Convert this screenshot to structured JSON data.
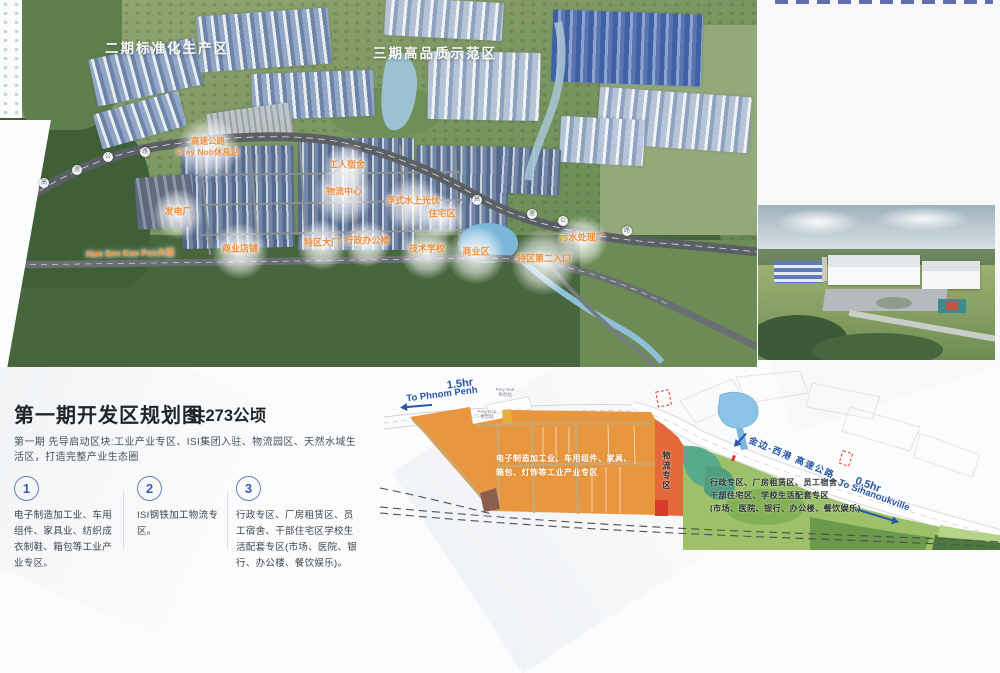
{
  "masterplan": {
    "zones": [
      {
        "label": "二期标准化生产区"
      },
      {
        "label": "三期高品质示范区"
      }
    ],
    "pois": [
      {
        "label": "高速公路"
      },
      {
        "label": "Prey Nob休息站"
      },
      {
        "label": "工人宿舍"
      },
      {
        "label": "物流中心"
      },
      {
        "label": "发电厂"
      },
      {
        "label": "浮式水上光伏"
      },
      {
        "label": "住宅区"
      },
      {
        "label": "商业店铺"
      },
      {
        "label": "特区大门"
      },
      {
        "label": "行政办公楼"
      },
      {
        "label": "技术学校"
      },
      {
        "label": "商业区"
      },
      {
        "label": "特区第二入口"
      },
      {
        "label": "污水处理厂"
      }
    ],
    "avenue_label": "Hun Sen Kao Pos大道",
    "road_shield_chars": [
      "高",
      "速",
      "公",
      "路",
      "高",
      "速",
      "公",
      "路"
    ],
    "label_color": "#ef8f3c"
  },
  "intro": {
    "title": "第一期开发区规划图",
    "area": "共273公顷",
    "subtitle": "第一期 先导启动区块:工业产业专区、ISI集团入驻、物流园区、天然水域生活区，打造完整产业生态圈",
    "items": [
      {
        "num": "1",
        "text": "电子制造加工业、车用组件、家具业、纺织成衣制鞋、箱包等工业产业专区。"
      },
      {
        "num": "2",
        "text": "ISI钢铁加工物流专区。"
      },
      {
        "num": "3",
        "text": "行政专区、厂房租赁区、员工宿舍、干部住宅区学校生活配套专区(市场、医院、银行、办公楼、餐饮娱乐)。"
      }
    ]
  },
  "plan": {
    "pp_time": "1.5hr",
    "pp_dest": "To Phnom Penh",
    "shv_time": "0.5hr",
    "shv_dest": "To Sihanoukville",
    "expressway": "金边-西港 高速公路",
    "rest_line1": "Prey Nob",
    "rest_line2": "休息站",
    "industrial_line1": "电子制造加工业、车用组件、家具、",
    "industrial_line2": "箱包、灯饰等工业产业专区",
    "logistics": "物流专区",
    "living_line1": "行政专区、厂房租赁区、员工宿舍、",
    "living_line2": "干部住宅区、学校生活配套专区",
    "living_line3": "(市场、医院、银行、办公楼、餐饮娱乐)",
    "colors": {
      "industrial_zone": "#e9973f",
      "logistics_zone": "#e4693a",
      "living_zone": "#9cc168",
      "water": "#8ac3e6",
      "highway_text": "#2856a8",
      "poi_label": "#ef8f3c"
    }
  }
}
